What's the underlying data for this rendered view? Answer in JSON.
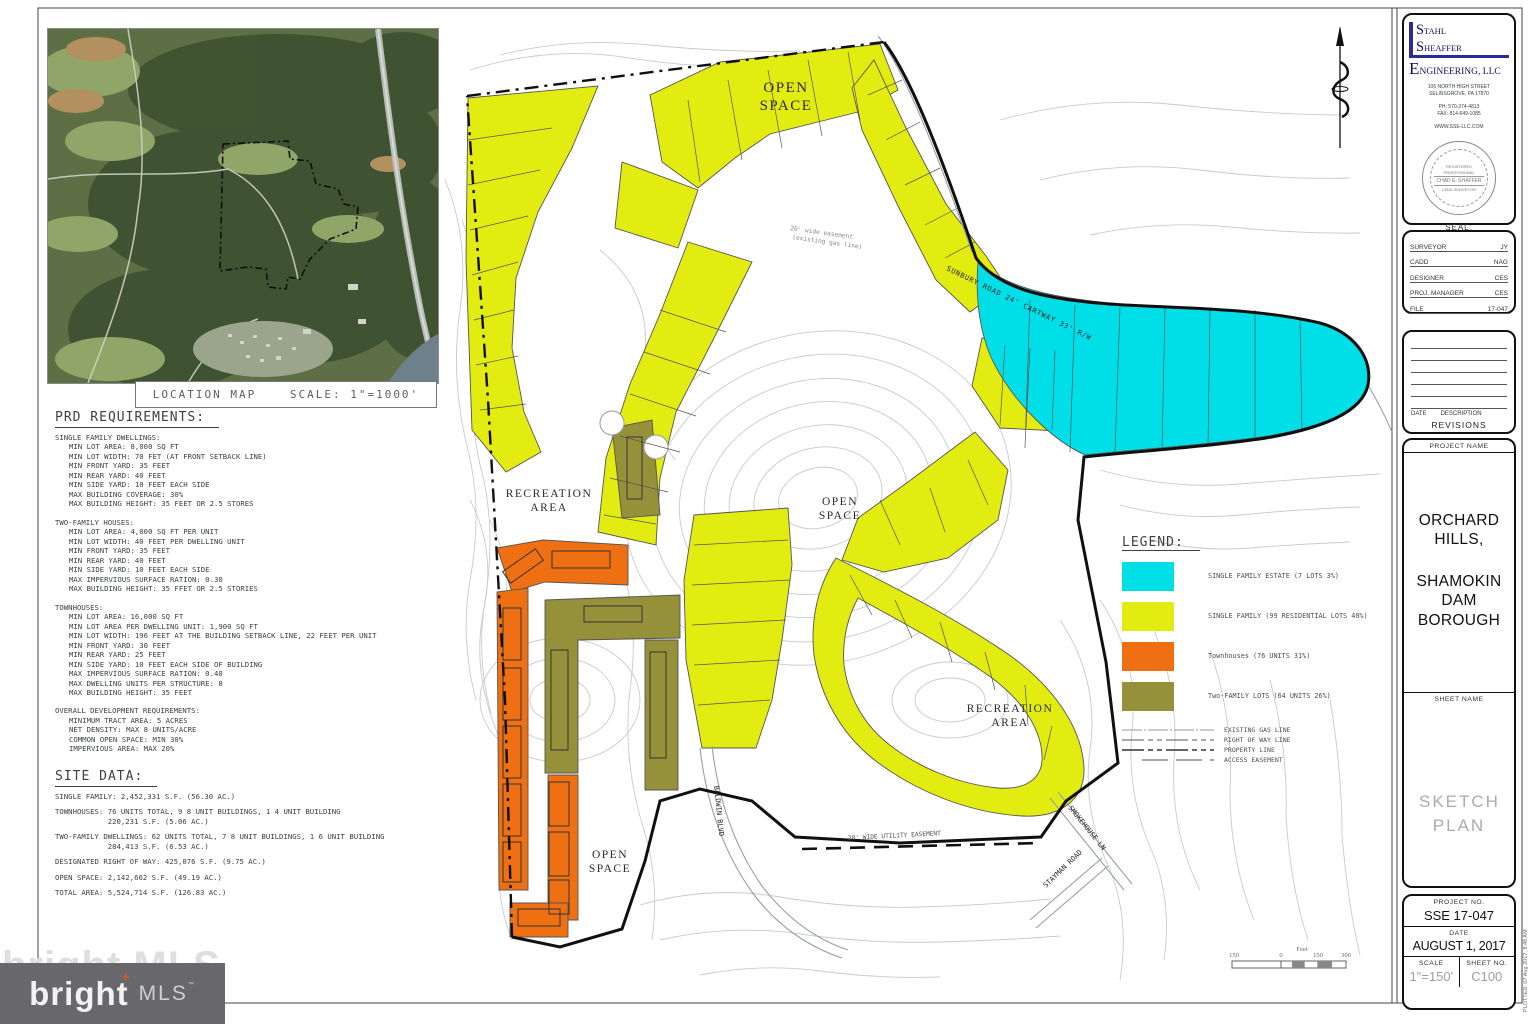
{
  "location_map": {
    "label": "LOCATION MAP",
    "scale": "SCALE: 1\"=1000'"
  },
  "prd": {
    "title": "PRD REQUIREMENTS:",
    "sections": [
      {
        "heading": "SINGLE FAMILY DWELLINGS:",
        "body": "MIN LOT AREA: 8,000 SQ FT\nMIN LOT WIDTH: 70 FET (AT FRONT SETBACK LINE)\nMIN FRONT YARD: 35 FEET\nMIN REAR YARD: 40 FEET\nMIN SIDE YARD: 10 FEET EACH SIDE\nMAX BUILDING COVERAGE: 30%\nMAX BUILDING HEIGHT: 35 FEET OR 2.5 STORES"
      },
      {
        "heading": "TWO-FAMILY HOUSES:",
        "body": "MIN LOT AREA: 4,000 SQ FT PER UNIT\nMIN LOT WIDTH: 40 FEET PER DWELLING UNIT\nMIN FRONT YARD: 35 FEET\nMIN REAR YARD: 40 FEET\nMIN SIDE YARD: 10 FEET EACH SIDE\nMAX IMPERVIOUS SURFACE RATION: 0.30\nMAX BUILDING HEIGHT: 35 FFET OR 2.5 STORIES"
      },
      {
        "heading": "TOWNHOUSES:",
        "body": "MIN LOT AREA: 16,000 SQ FT\nMIN LOT AREA PER DWELLING UNIT: 1,900 SQ FT\nMIN LOT WIDTH: 196 FEET AT THE BUILDING SETBACK LINE, 22 FEET PER UNIT\nMIN FRONT YARD: 30 FEET\nMIN REAR YARD: 25 FEET\nMIN SIDE YARD: 10 FEET EACH SIDE OF BUILDING\nMAX IMPERVIOUS SURFACE RATION: 0.40\nMAX DWELLING UNITS PER STRUCTURE: 8\nMAX BUILDING HEIGHT: 35 FEET"
      },
      {
        "heading": "OVERALL DEVELOPMENT REQUIREMENTS:",
        "body": "MINIMUM TRACT AREA: 5 ACRES\nNET DENSITY: MAX 8 UNITS/ACRE\nCOMMON OPEN SPACE: MIN 30%\nIMPERVIOUS AREA: MAX 20%"
      }
    ]
  },
  "site_data": {
    "title": "SITE DATA:",
    "entries": [
      "SINGLE FAMILY: 2,452,331 S.F. (56.30 AC.)",
      "TOWNHOUSES: 76 UNITS TOTAL, 9 8 UNIT BUILDINGS, 1 4 UNIT BUILDING\n            220,231 S.F. (5.06 AC.)",
      "TWO-FAMILY DWELLINGS: 62 UNITS TOTAL, 7 8 UNIT BUILDINGS, 1 6 UNIT BUILDING\n            284,413 S.F. (6.53 AC.)",
      "DESIGNATED RIGHT OF WAY: 425,076 S.F. (9.75 AC.)",
      "OPEN SPACE: 2,142,662 S.F. (49.19 AC.)",
      "TOTAL AREA: 5,524,714 S.F. (126.83 AC.)"
    ]
  },
  "plan": {
    "labels": {
      "open_space_top": [
        "OPEN",
        "SPACE"
      ],
      "recreation_left": [
        "RECREATION",
        "AREA"
      ],
      "open_space_center": [
        "OPEN",
        "SPACE"
      ],
      "recreation_right": [
        "RECREATION",
        "AREA"
      ],
      "open_space_bottom": [
        "OPEN",
        "SPACE"
      ]
    },
    "roads": {
      "sunbury": "SUNBURY ROAD   24' CARTWAY    33' R/W",
      "baldwin": "BALDWIN BLVD",
      "smokehouse": "SMOKEHOUSE LN",
      "stayman": "STAYMAN ROAD",
      "gas_easement_note_line1": "20' wide easement",
      "gas_easement_note_line2": "(existing gas line)",
      "utility_easement": "20' WIDE UTILITY EASEMENT"
    },
    "scale_bar": {
      "labels": [
        "150",
        "0",
        "150",
        "300"
      ],
      "unit": "Feet"
    },
    "zone_colors": {
      "single_family_estate": "#00dfe8",
      "single_family": "#e3ec10",
      "townhouses": "#ef7012",
      "two_family": "#95913a"
    }
  },
  "legend": {
    "title": "LEGEND:",
    "items": [
      {
        "label": "SINGLE FAMILY ESTATE (7 LOTS 3%)",
        "color": "#00dfe8"
      },
      {
        "label": "SINGLE FAMILY (99 RESIDENTIAL LOTS 40%)",
        "color": "#e3ec10"
      },
      {
        "label": "Townhouses (76 UNITS 31%)",
        "color": "#ef7012"
      },
      {
        "label": "Two-FAMILY LOTS (64 UNITS 26%)",
        "color": "#95913a"
      }
    ],
    "line_items": [
      "EXISTING GAS LINE",
      "RIGHT OF WAY LINE",
      "PROPERTY LINE",
      "ACCESS EASEMENT"
    ]
  },
  "title_block": {
    "firm_name_lines": [
      "Stahl",
      "Sheaffer",
      "Engineering, LLC"
    ],
    "address_lines": [
      "106 NORTH HIGH STREET",
      "SELINSGROVE, PA 17870"
    ],
    "phone": "PH: 570-374-4813",
    "fax": "FAX: 814-649-1085",
    "website": "WWW.SSE-LLC.COM",
    "seal": {
      "label": "SEAL:",
      "line1": "REGISTERED",
      "line2": "PROFESSIONAL",
      "name": "CHAD E. SHAFFER",
      "line3": "LAND SURVEYOR"
    },
    "credits": [
      {
        "label": "SURVEYOR",
        "value": "JY"
      },
      {
        "label": "CADD",
        "value": "NAG"
      },
      {
        "label": "DESIGNER",
        "value": "CES"
      },
      {
        "label": "PROJ. MANAGER",
        "value": "CES"
      },
      {
        "label": "FILE",
        "value": "17-047"
      }
    ],
    "revisions": {
      "date_label": "DATE",
      "description_label": "DESCRIPTION",
      "title": "REVISIONS"
    },
    "project_name_label": "PROJECT NAME",
    "project_name_line1": "ORCHARD HILLS,",
    "project_name_line2": "SHAMOKIN DAM BOROUGH",
    "sheet_name_label": "SHEET NAME",
    "sheet_name": "SKETCH PLAN",
    "project_no_label": "PROJECT NO.",
    "project_no": "SSE 17-047",
    "date_label": "DATE",
    "date": "AUGUST 1, 2017",
    "scale_label": "SCALE",
    "scale": "1\"=150'",
    "sheet_no_label": "SHEET NO.",
    "sheet_no": "C100",
    "plotted_note": "PLOTTED:  07 Aug 2017,  8:48 AM"
  },
  "footer_logo": {
    "brand": "bright",
    "suffix": "MLS",
    "trademark": "™",
    "plus": "+",
    "watermark": "bright MLS"
  }
}
